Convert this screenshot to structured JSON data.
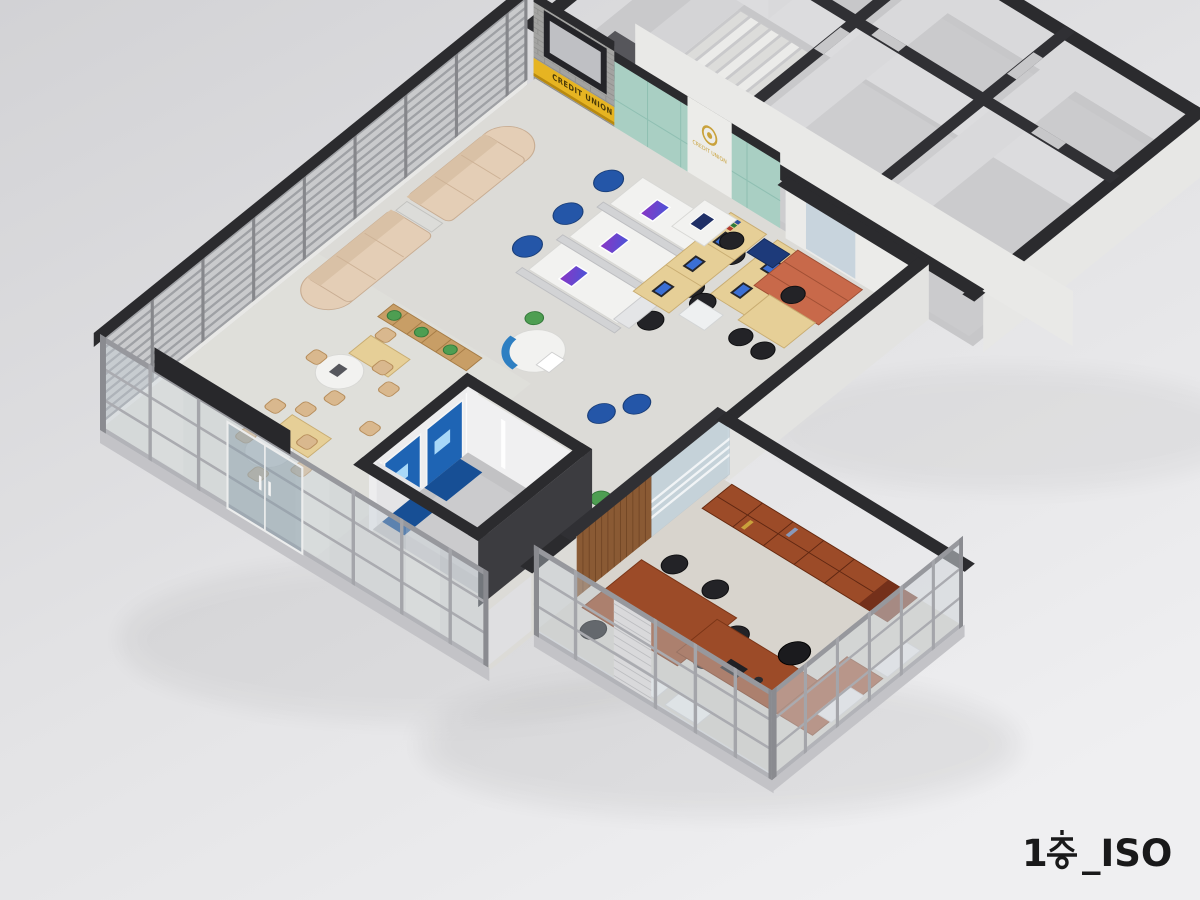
{
  "scene": {
    "title": "1층_ISO",
    "title_prefix": "1",
    "title_suffix": "_ISO",
    "view": "isometric-cutaway-floorplan-render"
  },
  "signage": {
    "credit_sign_text": "CREDIT UNION",
    "logo_text": "CREDIT UNION",
    "logo_icon": "gold-emblem-icon"
  },
  "colors": {
    "background_top": "#d2d2d5",
    "background_bottom": "#efeff1",
    "wall_cap": "#2b2b2e",
    "teal_wall": "#a9cfc3",
    "sign_yellow": "#e6b422",
    "brand_gold": "#c9a23c",
    "sofa_beige": "#e4ceb6",
    "client_chair_blue": "#2456a8",
    "atm_blue": "#1e64b4",
    "counter_white": "#f2f2f0",
    "birch_wood": "#e6cf97",
    "cherry_wood": "#9c4b28",
    "cabinet_orange": "#c8694a",
    "floor_light": "#dcdbd7",
    "glass_mullion": "#a4a5aa"
  },
  "areas": [
    {
      "name": "cafe-corner"
    },
    {
      "name": "customer-waiting-lounge"
    },
    {
      "name": "teller-counters"
    },
    {
      "name": "staff-desk-area"
    },
    {
      "name": "reception-desk"
    },
    {
      "name": "consultation-nook"
    },
    {
      "name": "atm-booth"
    },
    {
      "name": "executive-office"
    },
    {
      "name": "stair-hall"
    },
    {
      "name": "back-office-rooms"
    },
    {
      "name": "entrance-curtain-wall"
    }
  ]
}
